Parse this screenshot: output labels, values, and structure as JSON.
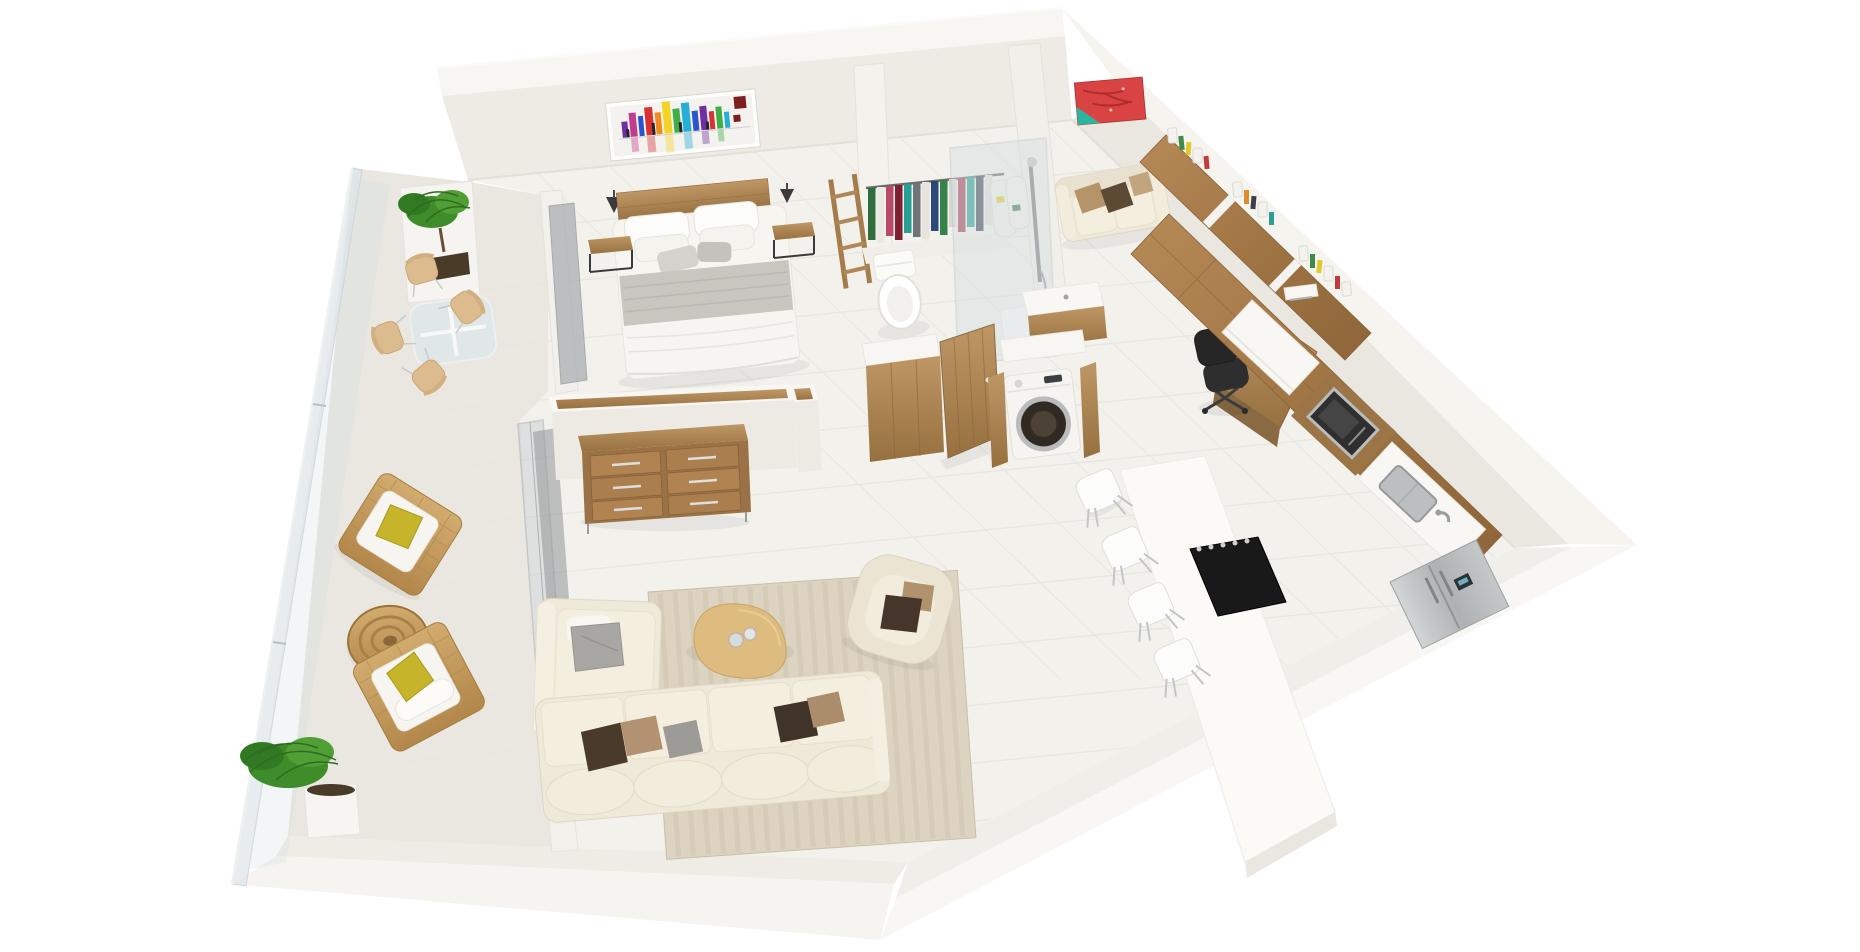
{
  "scene": {
    "title": "3D rendered apartment floor plan, isometric top-down view",
    "type": "architectural-3d-floor-plan",
    "background_color": "#ffffff"
  },
  "palette": {
    "wall_top": "#f6f5f1",
    "wall_face": "#edebe4",
    "floor": "#f3f1ec",
    "floor_seam": "#e6e4dd",
    "balcony_floor": "#e9e7e0",
    "wood": "#a97f4f",
    "wood_light": "#bf9765",
    "wicker": "#c8a368",
    "sofa_cream": "#efe9d9",
    "rug": "#dcd3c0",
    "glass": "#c3cccf",
    "steel": "#b9bcbd",
    "appliance_black": "#1a1a1a",
    "plant_green": "#3f8c2b",
    "pillow_yellow": "#c6b52a",
    "pillow_brown": "#4a3a2a",
    "pillow_tan": "#b29271"
  },
  "rooms": [
    {
      "name": "bedroom",
      "furniture": [
        "double-bed-white-gray-bedding",
        "wood-headboard",
        "nightstand-left",
        "nightstand-right",
        "wall-sconce-left",
        "wall-sconce-right",
        "colorful-skyline-artwork",
        "decorative-wood-ladder",
        "gray-sliding-door"
      ]
    },
    {
      "name": "bathroom",
      "furniture": [
        "clothes-rail-with-garments",
        "toilet",
        "walk-in-shower-glass",
        "chrome-shower-column",
        "sink-counter-wood-front",
        "vanity-wood-front",
        "open-wood-door",
        "washing-machine-in-wood-cabinet"
      ]
    },
    {
      "name": "study",
      "furniture": [
        "red-abstract-painting",
        "cream-loveseat-with-pillows",
        "wood-bookshelf-run-with-books",
        "wall-shelf",
        "wood-desk-with-papers",
        "black-office-chair"
      ]
    },
    {
      "name": "kitchen",
      "furniture": [
        "wood-cabinet-run",
        "built-in-microwave",
        "white-counter-upper",
        "sink-counter-stainless-sink",
        "stainless-fridge",
        "white-island-bar",
        "black-cooktop-five-knobs",
        "bar-chairs-white"
      ],
      "bar_chair_count": 4
    },
    {
      "name": "living-room",
      "furniture": [
        "half-wall-wood-cap",
        "wood-dresser-six-drawers",
        "striped-beige-rug",
        "organic-wood-coffee-table-with-cups",
        "cream-l-shaped-sectional",
        "cream-armchair",
        "sliding-glass-doors"
      ],
      "dresser_drawer_count": 6
    },
    {
      "name": "balcony",
      "furniture": [
        "glass-railing",
        "white-planter-with-plant",
        "glass-dining-table",
        "wood-dining-chairs",
        "wicker-armchair-upper",
        "wicker-armchair-lower",
        "round-wicker-ottoman",
        "potted-plant-south"
      ],
      "dining_chair_count": 4
    }
  ],
  "artwork": {
    "bedroom_skyline_colors": [
      "#6f2fa0",
      "#2b55d0",
      "#27aed6",
      "#d93131",
      "#3fae47",
      "#f3d327",
      "#f08c1e",
      "#c23b8e",
      "#23232b",
      "#7e1f1f"
    ],
    "study_painting_colors": [
      "#d94343",
      "#2bb5a0",
      "#a82525"
    ]
  },
  "closet_garment_colors": [
    "#2f6d3c",
    "#ece9e2",
    "#b84a66",
    "#7e1f32",
    "#28a093",
    "#6f7479",
    "#e7e4dd",
    "#2c4a78",
    "#37824a",
    "#d9d7d1",
    "#a83c55",
    "#23a092",
    "#3e444d",
    "#e2dfd8",
    "#7e1f32"
  ],
  "book_colors": [
    "#3e8a46",
    "#e0c92c",
    "#c43a3a",
    "#3a3f46",
    "#dd8b2d",
    "#2aa093",
    "#f3f2ee"
  ]
}
